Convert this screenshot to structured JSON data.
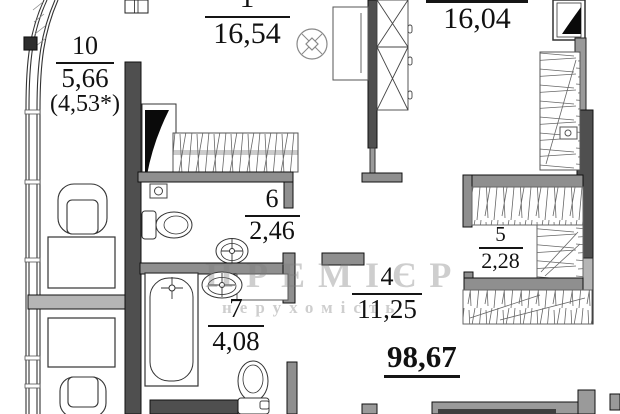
{
  "plan": {
    "title": "apartment floor plan",
    "total_area": "98,67",
    "watermark": {
      "line1": "ПРЕМІЄР",
      "line2": "нерухомість"
    },
    "rooms": {
      "r1": {
        "number": "1",
        "area": "16,54"
      },
      "r2": {
        "area": "16,04"
      },
      "r4": {
        "number": "4",
        "area": "11,25"
      },
      "r5": {
        "number": "5",
        "area": "2,28"
      },
      "r6": {
        "number": "6",
        "area": "2,46"
      },
      "r7": {
        "number": "7",
        "area": "4,08"
      },
      "r10": {
        "number": "10",
        "area": "5,66",
        "note": "(4,53*)"
      }
    },
    "icons": {
      "stove_symbol": "circle-with-cross"
    },
    "colors": {
      "background": "#ffffff",
      "wall_dark": "#4f4f4f",
      "wall_medium": "#8f8f8f",
      "wall_light": "#b5b5b5",
      "door_leaf": "#0a0a0a",
      "outline": "#333333",
      "watermark": "#8c8c8c"
    }
  }
}
